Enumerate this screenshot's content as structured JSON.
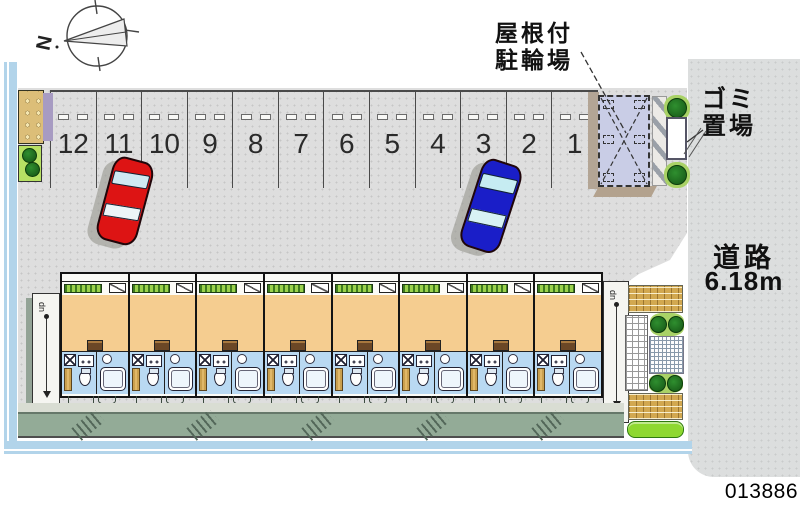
{
  "compass": {
    "north_label": "N"
  },
  "labels": {
    "bike_parking_line1": "屋根付",
    "bike_parking_line2": "駐輪場",
    "garbage_line1": "ゴミ",
    "garbage_line2": "置場",
    "road": "道路",
    "road_width": "6.18m",
    "plan_id": "013886",
    "stair_up": "dn"
  },
  "parking": {
    "spaces": [
      "12",
      "11",
      "10",
      "9",
      "8",
      "7",
      "6",
      "5",
      "4",
      "3",
      "2",
      "1"
    ]
  },
  "building": {
    "unit_count": 8
  },
  "colors": {
    "site_gray": "#dedede",
    "road_gray": "#dcdede",
    "water_blue": "#b2d4ea",
    "room_orange": "#f5cd90",
    "wet_blue": "#b9d9f2",
    "bike_lavender": "#c9cde6",
    "car_red": "#dd1414",
    "car_blue": "#1a1ec8",
    "brick_tan": "#d2a850",
    "bush_green": "#8ed830",
    "walkway_green": "#93ab97"
  }
}
